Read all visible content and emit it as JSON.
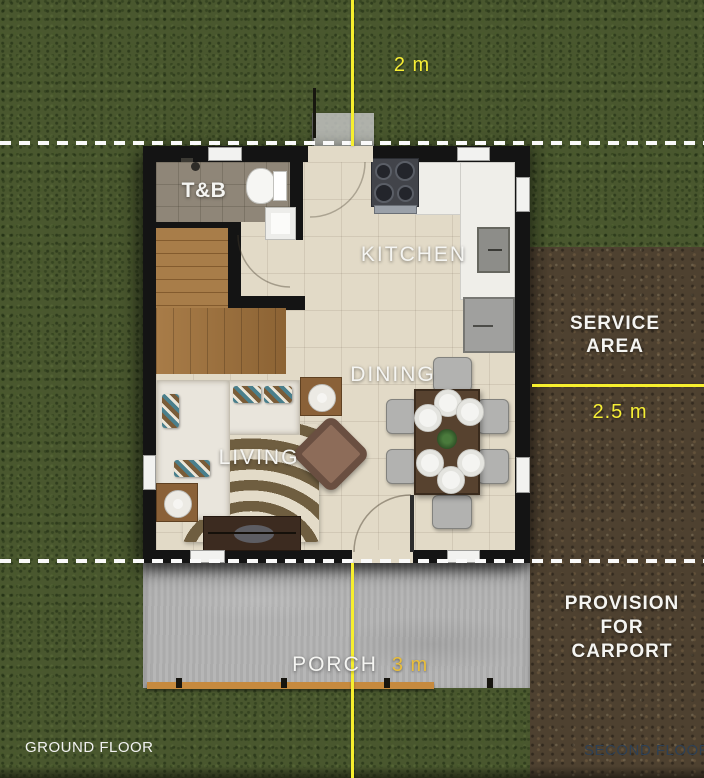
{
  "floor_plan": {
    "title": "GROUND FLOOR",
    "next_sheet_label": "SECOND FLOOR",
    "rooms": {
      "toilet_bath": "T&B",
      "kitchen": "KITCHEN",
      "dining": "DINING",
      "living": "LIVING",
      "porch": "PORCH"
    },
    "outdoor_areas": {
      "service_area": [
        "SERVICE",
        "AREA"
      ],
      "carport": [
        "PROVISION",
        "FOR",
        "CARPORT"
      ]
    },
    "dimensions": {
      "rear_setback": "2 m",
      "side_setback": "2.5 m",
      "front_setback": "3 m"
    },
    "colors": {
      "dimension_accent": "#f7ef2e",
      "front_dimension_text": "#e9be3b",
      "grass": "#49572e",
      "soil": "#4e4130",
      "wall": "#141414",
      "floor_tile": "#e2dac7",
      "porch_concrete": "#b2b2b2"
    }
  }
}
